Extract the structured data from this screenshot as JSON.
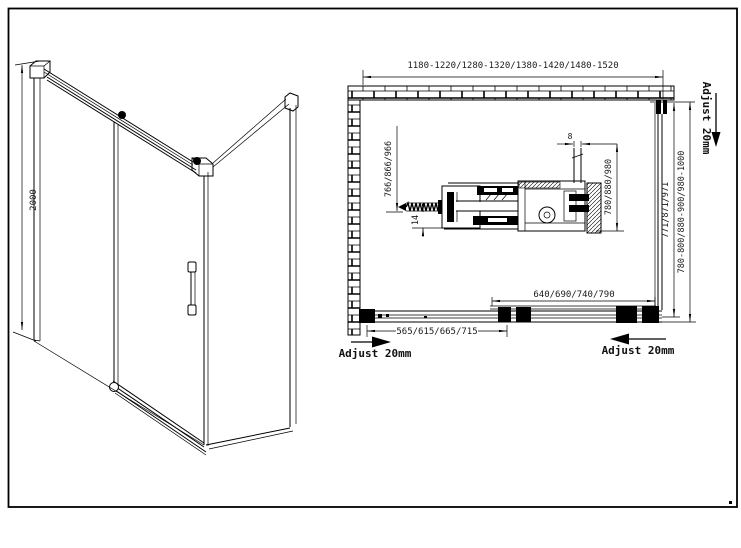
{
  "colors": {
    "line": "#000000",
    "text": "#1a1a1a",
    "background": "#ffffff"
  },
  "iso_view": {
    "height_dim": "2000"
  },
  "plan_view": {
    "overall_width_dim": "1180-1220/1280-1320/1380-1420/1480-1520",
    "left_depth_dim": "766/866/966",
    "glass_offset_dim": "14",
    "glass_thickness_dim": "8",
    "side_panel_dim": "780/880/980",
    "inner_depth_dim": "771/871/971",
    "overall_depth_dim": "780-800/880-900/980-1000",
    "door_panel_width_dim": "640/690/740/790",
    "opening_width_dim": "565/615/665/715",
    "adjust_top_right": "Adjust 20mm",
    "adjust_bottom_left": "Adjust 20mm",
    "adjust_bottom_right": "Adjust 20mm"
  }
}
